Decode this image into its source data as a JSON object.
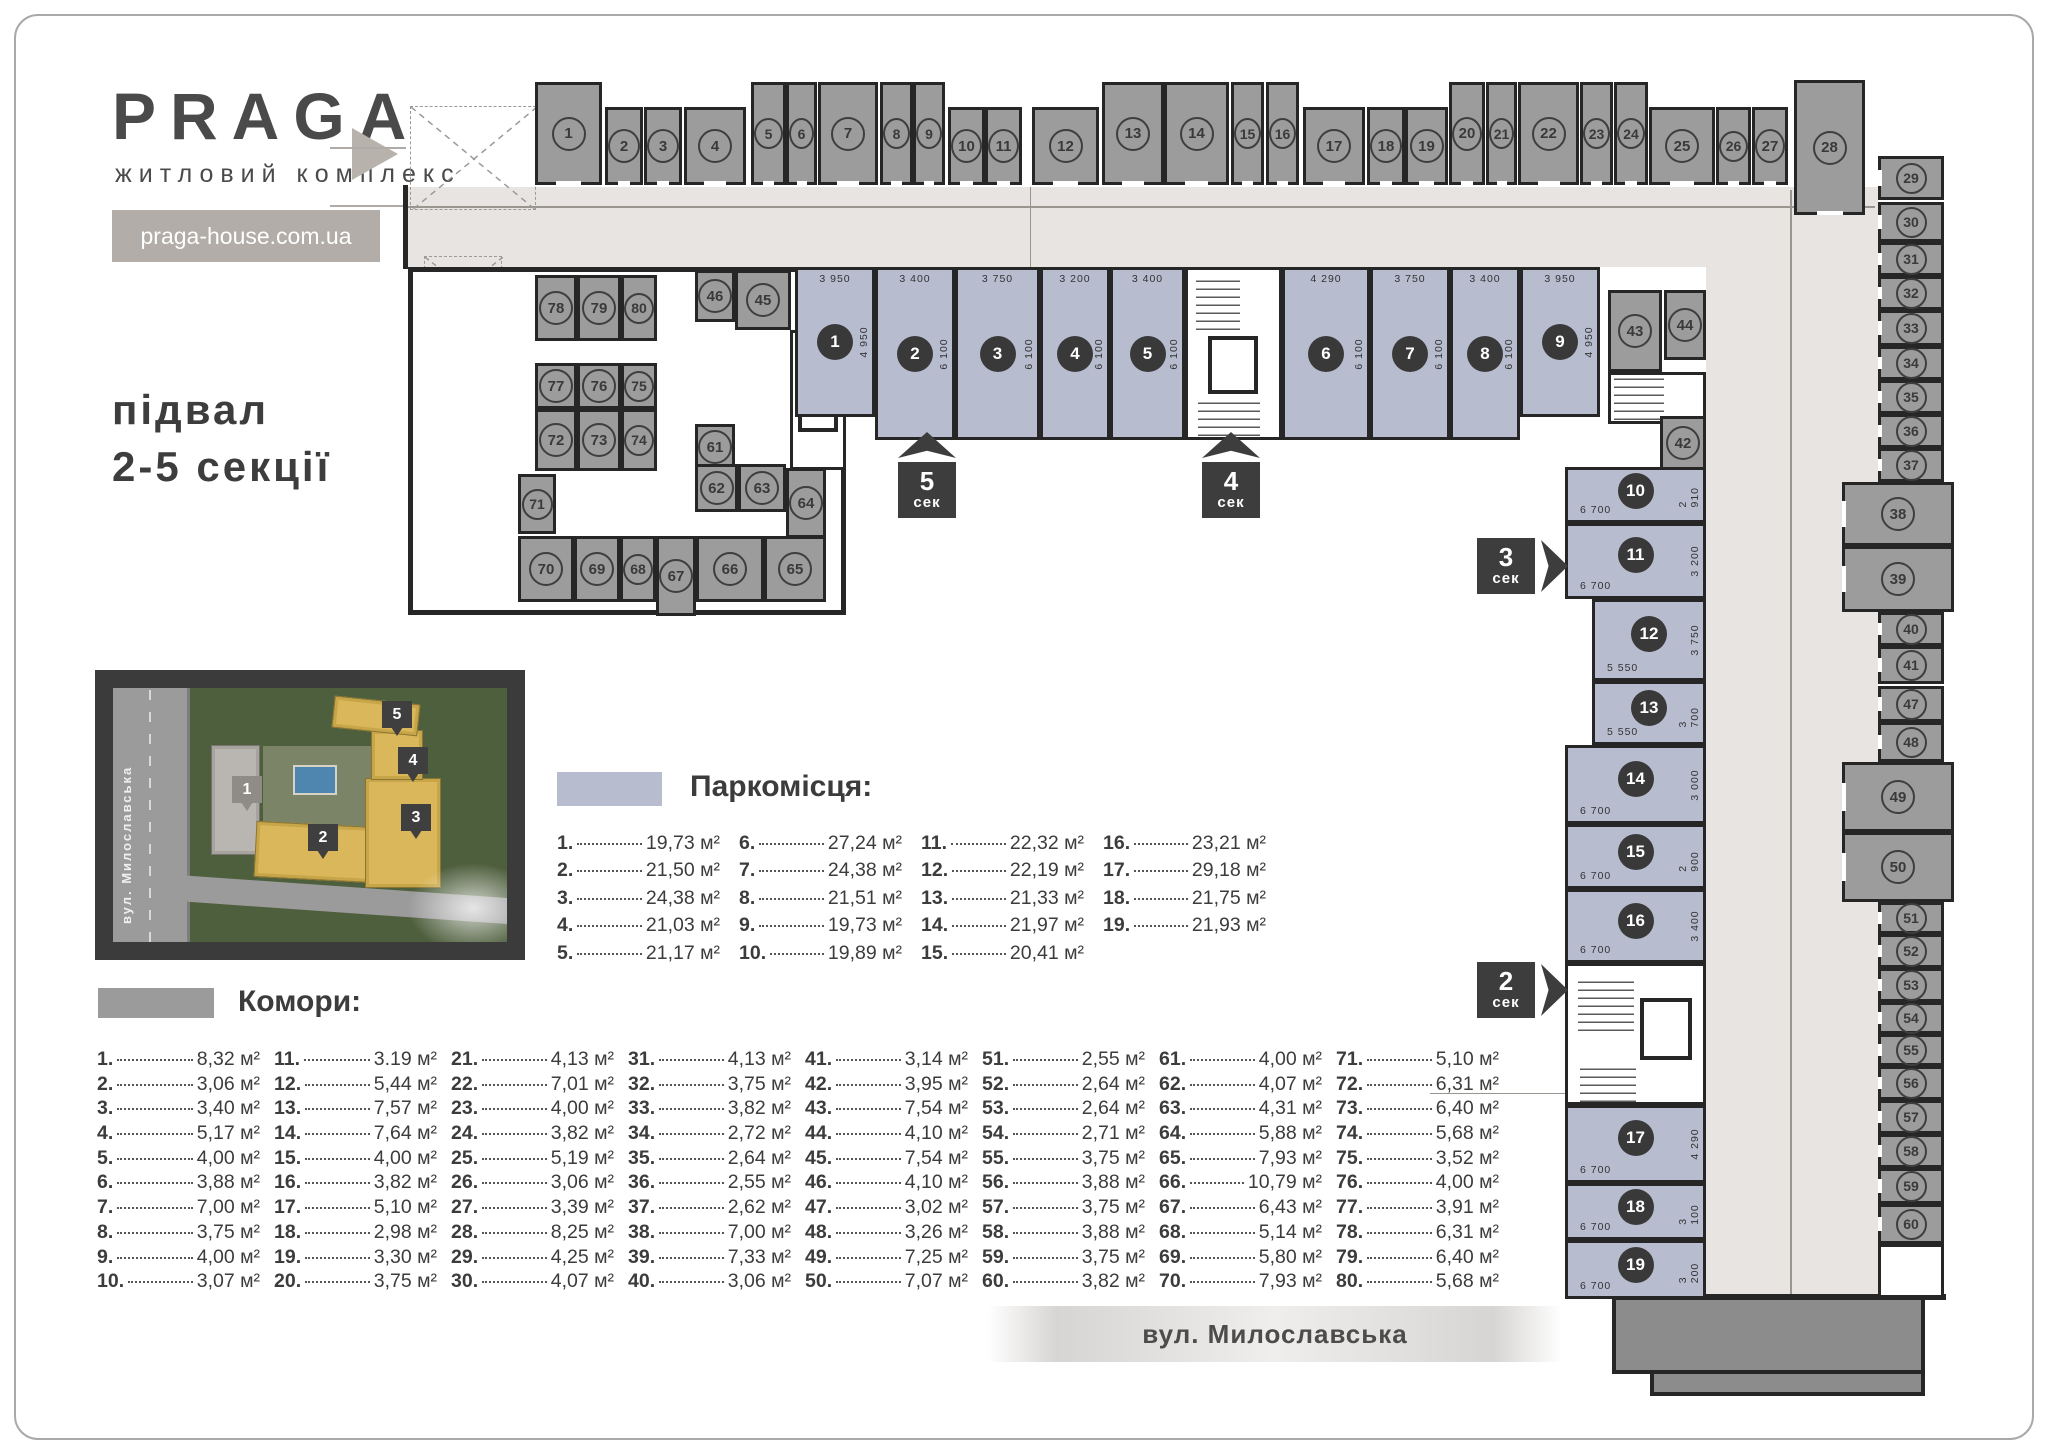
{
  "brand": {
    "logo": "PRAGA",
    "tagline": "житловий комплекс",
    "website": "praga-house.com.ua"
  },
  "heading": {
    "line1": "підвал",
    "line2": "2-5 секції"
  },
  "street_band": {
    "label": "вул. Милославська"
  },
  "site_plan": {
    "street_label": "вул. Милославська",
    "pins": [
      {
        "n": "1",
        "x": 119,
        "y": 88,
        "light": true
      },
      {
        "n": "2",
        "x": 195,
        "y": 136,
        "light": false
      },
      {
        "n": "3",
        "x": 288,
        "y": 116,
        "light": false
      },
      {
        "n": "4",
        "x": 285,
        "y": 59,
        "light": false
      },
      {
        "n": "5",
        "x": 269,
        "y": 13,
        "light": false
      }
    ]
  },
  "legend_parking": {
    "title": "Паркомісця:",
    "swatch_color": "#b7bccf",
    "unit": "м²",
    "items": [
      {
        "n": "1",
        "area": "19,73"
      },
      {
        "n": "2",
        "area": "21,50"
      },
      {
        "n": "3",
        "area": "24,38"
      },
      {
        "n": "4",
        "area": "21,03"
      },
      {
        "n": "5",
        "area": "21,17"
      },
      {
        "n": "6",
        "area": "27,24"
      },
      {
        "n": "7",
        "area": "24,38"
      },
      {
        "n": "8",
        "area": "21,51"
      },
      {
        "n": "9",
        "area": "19,73"
      },
      {
        "n": "10",
        "area": "19,89"
      },
      {
        "n": "11",
        "area": "22,32"
      },
      {
        "n": "12",
        "area": "22,19"
      },
      {
        "n": "13",
        "area": "21,33"
      },
      {
        "n": "14",
        "area": "21,97"
      },
      {
        "n": "15",
        "area": "20,41"
      },
      {
        "n": "16",
        "area": "23,21"
      },
      {
        "n": "17",
        "area": "29,18"
      },
      {
        "n": "18",
        "area": "21,75"
      },
      {
        "n": "19",
        "area": "21,93"
      }
    ]
  },
  "legend_storage": {
    "title": "Комори:",
    "swatch_color": "#9b9b9b",
    "unit": "м²",
    "items": [
      {
        "n": "1",
        "area": "8,32"
      },
      {
        "n": "2",
        "area": "3,06"
      },
      {
        "n": "3",
        "area": "3,40"
      },
      {
        "n": "4",
        "area": "5,17"
      },
      {
        "n": "5",
        "area": "4,00"
      },
      {
        "n": "6",
        "area": "3,88"
      },
      {
        "n": "7",
        "area": "7,00"
      },
      {
        "n": "8",
        "area": "3,75"
      },
      {
        "n": "9",
        "area": "4,00"
      },
      {
        "n": "10",
        "area": "3,07"
      },
      {
        "n": "11",
        "area": "3.19"
      },
      {
        "n": "12",
        "area": "5,44"
      },
      {
        "n": "13",
        "area": "7,57"
      },
      {
        "n": "14",
        "area": "7,64"
      },
      {
        "n": "15",
        "area": "4,00"
      },
      {
        "n": "16",
        "area": "3,82"
      },
      {
        "n": "17",
        "area": "5,10"
      },
      {
        "n": "18",
        "area": "2,98"
      },
      {
        "n": "19",
        "area": "3,30"
      },
      {
        "n": "20",
        "area": "3,75"
      },
      {
        "n": "21",
        "area": "4,13"
      },
      {
        "n": "22",
        "area": "7,01"
      },
      {
        "n": "23",
        "area": "4,00"
      },
      {
        "n": "24",
        "area": "3,82"
      },
      {
        "n": "25",
        "area": "5,19"
      },
      {
        "n": "26",
        "area": "3,06"
      },
      {
        "n": "27",
        "area": "3,39"
      },
      {
        "n": "28",
        "area": "8,25"
      },
      {
        "n": "29",
        "area": "4,25"
      },
      {
        "n": "30",
        "area": "4,07"
      },
      {
        "n": "31",
        "area": "4,13"
      },
      {
        "n": "32",
        "area": "3,75"
      },
      {
        "n": "33",
        "area": "3,82"
      },
      {
        "n": "34",
        "area": "2,72"
      },
      {
        "n": "35",
        "area": "2,64"
      },
      {
        "n": "36",
        "area": "2,55"
      },
      {
        "n": "37",
        "area": "2,62"
      },
      {
        "n": "38",
        "area": "7,00"
      },
      {
        "n": "39",
        "area": "7,33"
      },
      {
        "n": "40",
        "area": "3,06"
      },
      {
        "n": "41",
        "area": "3,14"
      },
      {
        "n": "42",
        "area": "3,95"
      },
      {
        "n": "43",
        "area": "7,54"
      },
      {
        "n": "44",
        "area": "4,10"
      },
      {
        "n": "45",
        "area": "7,54"
      },
      {
        "n": "46",
        "area": "4,10"
      },
      {
        "n": "47",
        "area": "3,02"
      },
      {
        "n": "48",
        "area": "3,26"
      },
      {
        "n": "49",
        "area": "7,25"
      },
      {
        "n": "50",
        "area": "7,07"
      },
      {
        "n": "51",
        "area": "2,55"
      },
      {
        "n": "52",
        "area": "2,64"
      },
      {
        "n": "53",
        "area": "2,64"
      },
      {
        "n": "54",
        "area": "2,71"
      },
      {
        "n": "55",
        "area": "3,75"
      },
      {
        "n": "56",
        "area": "3,88"
      },
      {
        "n": "57",
        "area": "3,75"
      },
      {
        "n": "58",
        "area": "3,88"
      },
      {
        "n": "59",
        "area": "3,75"
      },
      {
        "n": "60",
        "area": "3,82"
      },
      {
        "n": "61",
        "area": "4,00"
      },
      {
        "n": "62",
        "area": "4,07"
      },
      {
        "n": "63",
        "area": "4,31"
      },
      {
        "n": "64",
        "area": "5,88"
      },
      {
        "n": "65",
        "area": "7,93"
      },
      {
        "n": "66",
        "area": "10,79"
      },
      {
        "n": "67",
        "area": "6,43"
      },
      {
        "n": "68",
        "area": "5,14"
      },
      {
        "n": "69",
        "area": "5,80"
      },
      {
        "n": "70",
        "area": "7,93"
      },
      {
        "n": "71",
        "area": "5,10"
      },
      {
        "n": "72",
        "area": "6,31"
      },
      {
        "n": "73",
        "area": "6,40"
      },
      {
        "n": "74",
        "area": "5,68"
      },
      {
        "n": "75",
        "area": "3,52"
      },
      {
        "n": "76",
        "area": "4,00"
      },
      {
        "n": "77",
        "area": "3,91"
      },
      {
        "n": "78",
        "area": "6,31"
      },
      {
        "n": "79",
        "area": "6,40"
      },
      {
        "n": "80",
        "area": "5,68"
      }
    ]
  },
  "section_markers": [
    {
      "num": "5",
      "word": "сек",
      "dir": "up",
      "x": 898,
      "y": 432
    },
    {
      "num": "4",
      "word": "сек",
      "dir": "up",
      "x": 1202,
      "y": 432
    },
    {
      "num": "3",
      "word": "сек",
      "dir": "right",
      "x": 1477,
      "y": 538
    },
    {
      "num": "2",
      "word": "сек",
      "dir": "right",
      "x": 1477,
      "y": 962
    }
  ],
  "plan": {
    "top_rooms": [
      {
        "n": "1",
        "x": 535,
        "w": 67,
        "t": 1
      },
      {
        "n": "2",
        "x": 605,
        "w": 38,
        "t": 0
      },
      {
        "n": "3",
        "x": 644,
        "w": 38,
        "t": 0
      },
      {
        "n": "4",
        "x": 684,
        "w": 62,
        "t": 0
      },
      {
        "n": "5",
        "x": 751,
        "w": 35,
        "t": 1
      },
      {
        "n": "6",
        "x": 786,
        "w": 31,
        "t": 1
      },
      {
        "n": "7",
        "x": 818,
        "w": 60,
        "t": 1
      },
      {
        "n": "8",
        "x": 880,
        "w": 33,
        "t": 1
      },
      {
        "n": "9",
        "x": 913,
        "w": 32,
        "t": 1
      },
      {
        "n": "10",
        "x": 948,
        "w": 37,
        "t": 0
      },
      {
        "n": "11",
        "x": 985,
        "w": 37,
        "t": 0
      },
      {
        "n": "12",
        "x": 1032,
        "w": 67,
        "t": 0
      },
      {
        "n": "13",
        "x": 1102,
        "w": 62,
        "t": 1
      },
      {
        "n": "14",
        "x": 1164,
        "w": 65,
        "t": 1
      },
      {
        "n": "15",
        "x": 1231,
        "w": 33,
        "t": 1
      },
      {
        "n": "16",
        "x": 1266,
        "w": 33,
        "t": 1
      },
      {
        "n": "17",
        "x": 1303,
        "w": 62,
        "t": 0
      },
      {
        "n": "18",
        "x": 1367,
        "w": 38,
        "t": 0
      },
      {
        "n": "19",
        "x": 1405,
        "w": 43,
        "t": 0
      },
      {
        "n": "20",
        "x": 1449,
        "w": 36,
        "t": 1
      },
      {
        "n": "21",
        "x": 1486,
        "w": 31,
        "t": 1
      },
      {
        "n": "22",
        "x": 1518,
        "w": 61,
        "t": 1
      },
      {
        "n": "23",
        "x": 1580,
        "w": 33,
        "t": 1
      },
      {
        "n": "24",
        "x": 1614,
        "w": 34,
        "t": 1
      },
      {
        "n": "25",
        "x": 1649,
        "w": 66,
        "t": 0
      },
      {
        "n": "26",
        "x": 1716,
        "w": 35,
        "t": 0
      },
      {
        "n": "27",
        "x": 1752,
        "w": 36,
        "t": 0
      },
      {
        "n": "28",
        "x": 1794,
        "w": 71,
        "t": 2
      }
    ],
    "right_rooms": [
      {
        "n": "29",
        "y": 156,
        "h": 44,
        "big": 0
      },
      {
        "n": "30",
        "y": 202,
        "h": 40,
        "big": 0
      },
      {
        "n": "31",
        "y": 242,
        "h": 34,
        "big": 0
      },
      {
        "n": "32",
        "y": 276,
        "h": 34,
        "big": 0
      },
      {
        "n": "33",
        "y": 310,
        "h": 36,
        "big": 0
      },
      {
        "n": "34",
        "y": 346,
        "h": 34,
        "big": 0
      },
      {
        "n": "35",
        "y": 380,
        "h": 34,
        "big": 0
      },
      {
        "n": "36",
        "y": 414,
        "h": 34,
        "big": 0
      },
      {
        "n": "37",
        "y": 448,
        "h": 34,
        "big": 0
      },
      {
        "n": "38",
        "y": 482,
        "h": 64,
        "big": 1
      },
      {
        "n": "39",
        "y": 546,
        "h": 66,
        "big": 1
      },
      {
        "n": "40",
        "y": 612,
        "h": 34,
        "big": 0
      },
      {
        "n": "41",
        "y": 646,
        "h": 38,
        "big": 0
      },
      {
        "n": "47",
        "y": 686,
        "h": 36,
        "big": 0
      },
      {
        "n": "48",
        "y": 722,
        "h": 40,
        "big": 0
      },
      {
        "n": "49",
        "y": 762,
        "h": 70,
        "big": 1
      },
      {
        "n": "50",
        "y": 832,
        "h": 70,
        "big": 1
      },
      {
        "n": "51",
        "y": 902,
        "h": 32,
        "big": 0
      },
      {
        "n": "52",
        "y": 934,
        "h": 34,
        "big": 0
      },
      {
        "n": "53",
        "y": 968,
        "h": 34,
        "big": 0
      },
      {
        "n": "54",
        "y": 1002,
        "h": 32,
        "big": 0
      },
      {
        "n": "55",
        "y": 1034,
        "h": 32,
        "big": 0
      },
      {
        "n": "56",
        "y": 1066,
        "h": 34,
        "big": 0
      },
      {
        "n": "57",
        "y": 1100,
        "h": 34,
        "big": 0
      },
      {
        "n": "58",
        "y": 1134,
        "h": 34,
        "big": 0
      },
      {
        "n": "59",
        "y": 1168,
        "h": 36,
        "big": 0
      },
      {
        "n": "60",
        "y": 1204,
        "h": 40,
        "big": 0
      }
    ],
    "left_rooms": [
      {
        "n": "78",
        "x": 535,
        "y": 275,
        "w": 42,
        "h": 66
      },
      {
        "n": "79",
        "x": 577,
        "y": 275,
        "w": 44,
        "h": 66
      },
      {
        "n": "80",
        "x": 621,
        "y": 275,
        "w": 36,
        "h": 66
      },
      {
        "n": "46",
        "x": 695,
        "y": 270,
        "w": 40,
        "h": 52
      },
      {
        "n": "45",
        "x": 735,
        "y": 270,
        "w": 56,
        "h": 60
      },
      {
        "n": "77",
        "x": 535,
        "y": 363,
        "w": 42,
        "h": 46
      },
      {
        "n": "76",
        "x": 577,
        "y": 363,
        "w": 44,
        "h": 46
      },
      {
        "n": "75",
        "x": 621,
        "y": 363,
        "w": 36,
        "h": 46
      },
      {
        "n": "72",
        "x": 535,
        "y": 409,
        "w": 42,
        "h": 62
      },
      {
        "n": "73",
        "x": 577,
        "y": 409,
        "w": 44,
        "h": 62
      },
      {
        "n": "74",
        "x": 621,
        "y": 409,
        "w": 36,
        "h": 62
      },
      {
        "n": "61",
        "x": 695,
        "y": 424,
        "w": 40,
        "h": 46
      },
      {
        "n": "71",
        "x": 518,
        "y": 474,
        "w": 38,
        "h": 60
      },
      {
        "n": "62",
        "x": 695,
        "y": 464,
        "w": 43,
        "h": 48
      },
      {
        "n": "63",
        "x": 738,
        "y": 464,
        "w": 48,
        "h": 48
      },
      {
        "n": "64",
        "x": 786,
        "y": 468,
        "w": 40,
        "h": 70
      },
      {
        "n": "70",
        "x": 518,
        "y": 536,
        "w": 56,
        "h": 66
      },
      {
        "n": "69",
        "x": 574,
        "y": 536,
        "w": 46,
        "h": 66
      },
      {
        "n": "68",
        "x": 620,
        "y": 536,
        "w": 36,
        "h": 66
      },
      {
        "n": "67",
        "x": 656,
        "y": 536,
        "w": 40,
        "h": 80
      },
      {
        "n": "66",
        "x": 696,
        "y": 536,
        "w": 68,
        "h": 66
      },
      {
        "n": "65",
        "x": 764,
        "y": 536,
        "w": 62,
        "h": 66
      },
      {
        "n": "43",
        "x": 1608,
        "y": 290,
        "w": 54,
        "h": 82
      },
      {
        "n": "44",
        "x": 1664,
        "y": 290,
        "w": 42,
        "h": 70
      },
      {
        "n": "42",
        "x": 1660,
        "y": 416,
        "w": 46,
        "h": 54
      }
    ],
    "parking_row": [
      {
        "n": "1",
        "x": 795,
        "w": 80,
        "h": 150,
        "dw": "3 950",
        "dh": "4 950"
      },
      {
        "n": "2",
        "x": 875,
        "w": 80,
        "h": 173,
        "dw": "3 400",
        "dh": "6 100"
      },
      {
        "n": "3",
        "x": 955,
        "w": 85,
        "h": 173,
        "dw": "3 750",
        "dh": "6 100"
      },
      {
        "n": "4",
        "x": 1040,
        "w": 70,
        "h": 173,
        "dw": "3 200",
        "dh": "6 100"
      },
      {
        "n": "5",
        "x": 1110,
        "w": 75,
        "h": 173,
        "dw": "3 400",
        "dh": "6 100"
      },
      {
        "n": "6",
        "x": 1282,
        "w": 88,
        "h": 173,
        "dw": "4 290",
        "dh": "6 100"
      },
      {
        "n": "7",
        "x": 1370,
        "w": 80,
        "h": 173,
        "dw": "3 750",
        "dh": "6 100"
      },
      {
        "n": "8",
        "x": 1450,
        "w": 70,
        "h": 173,
        "dw": "3 400",
        "dh": "6 100"
      },
      {
        "n": "9",
        "x": 1520,
        "w": 80,
        "h": 150,
        "dw": "3 950",
        "dh": "4 950"
      }
    ],
    "parking_col": [
      {
        "n": "10",
        "x": 1565,
        "y": 467,
        "w": 141,
        "h": 56,
        "dw": "6 700",
        "dh": "2 910"
      },
      {
        "n": "11",
        "x": 1565,
        "y": 523,
        "w": 141,
        "h": 76,
        "dw": "6 700",
        "dh": "3 200"
      },
      {
        "n": "12",
        "x": 1592,
        "y": 599,
        "w": 114,
        "h": 82,
        "dw": "5 550",
        "dh": "3 750"
      },
      {
        "n": "13",
        "x": 1592,
        "y": 681,
        "w": 114,
        "h": 64,
        "dw": "5 550",
        "dh": "3 700"
      },
      {
        "n": "14",
        "x": 1565,
        "y": 745,
        "w": 141,
        "h": 79,
        "dw": "6 700",
        "dh": "3 000"
      },
      {
        "n": "15",
        "x": 1565,
        "y": 824,
        "w": 141,
        "h": 65,
        "dw": "6 700",
        "dh": "2 900"
      },
      {
        "n": "16",
        "x": 1565,
        "y": 889,
        "w": 141,
        "h": 74,
        "dw": "6 700",
        "dh": "3 400"
      },
      {
        "n": "17",
        "x": 1565,
        "y": 1105,
        "w": 141,
        "h": 78,
        "dw": "6 700",
        "dh": "4 290"
      },
      {
        "n": "18",
        "x": 1565,
        "y": 1183,
        "w": 141,
        "h": 57,
        "dw": "6 700",
        "dh": "3 100"
      },
      {
        "n": "19",
        "x": 1565,
        "y": 1240,
        "w": 141,
        "h": 59,
        "dw": "6 700",
        "dh": "3 200"
      }
    ]
  }
}
